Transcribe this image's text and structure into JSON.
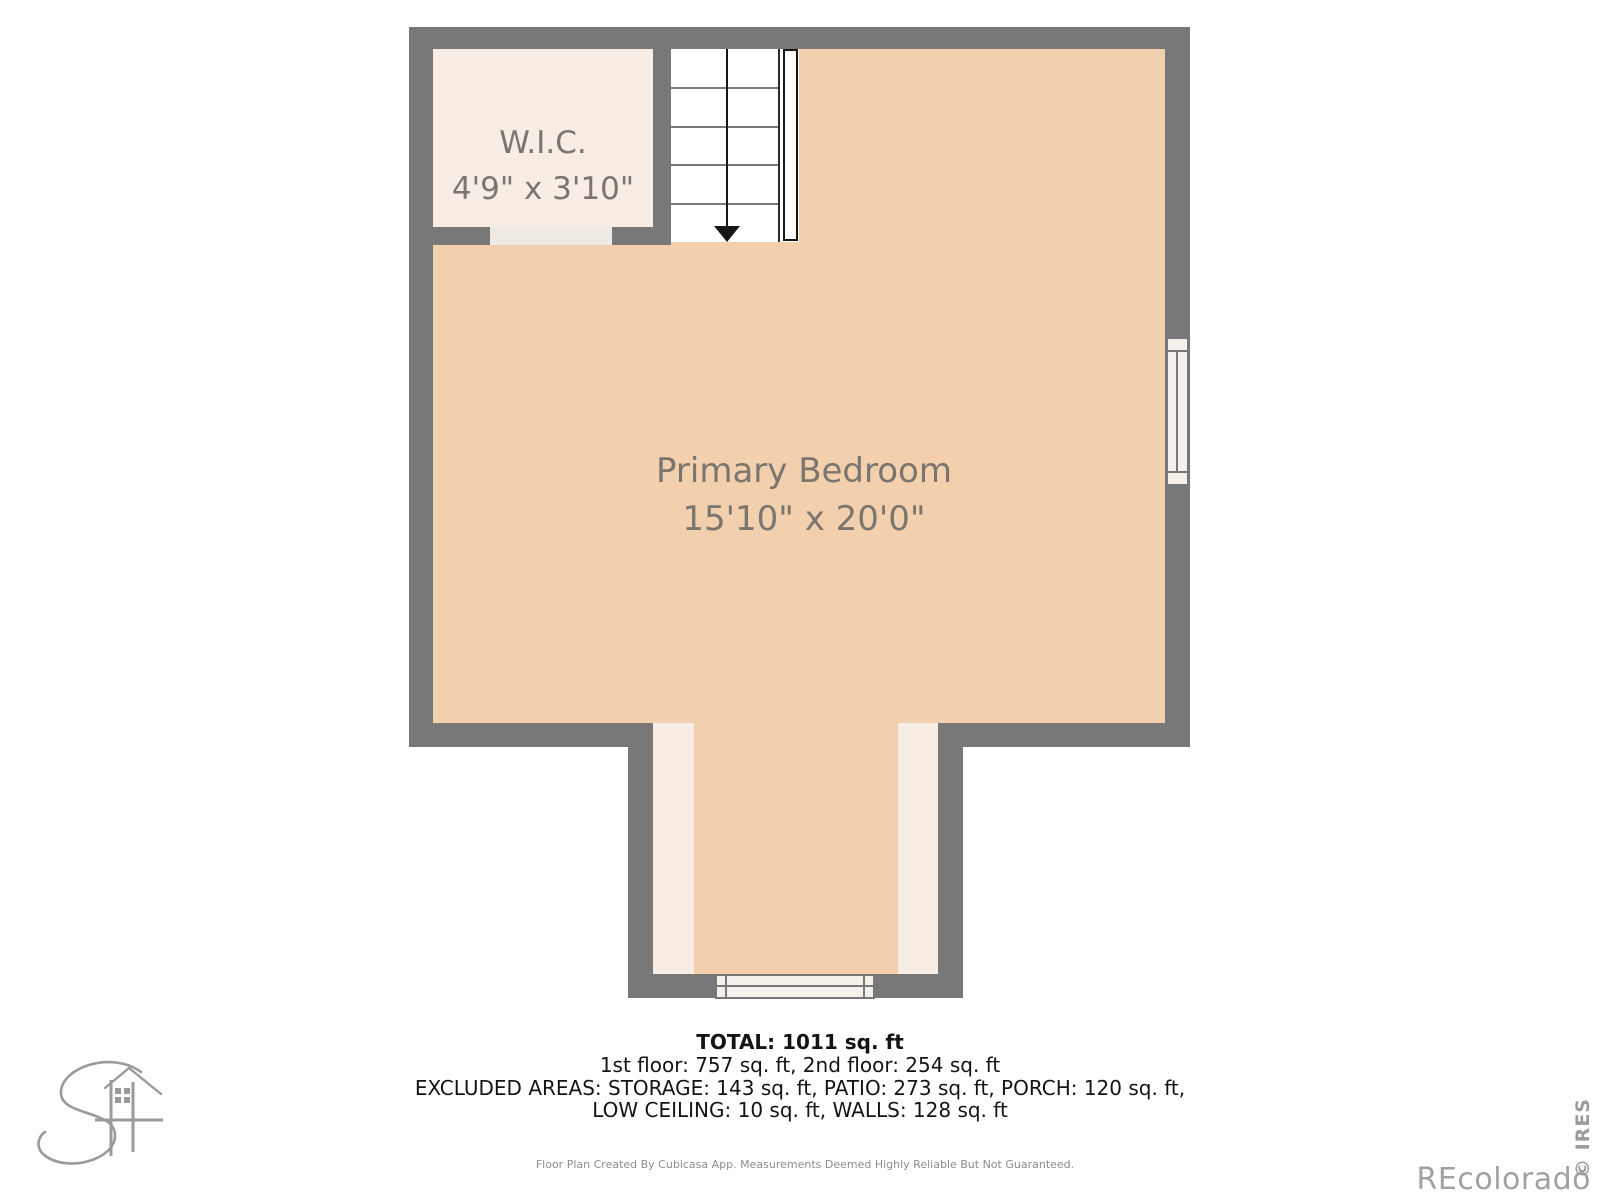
{
  "plan": {
    "rooms": {
      "wic": {
        "name": "W.I.C.",
        "dims": "4'9\" x 3'10\""
      },
      "bedroom": {
        "name": "Primary Bedroom",
        "dims": "15'10\" x 20'0\""
      }
    },
    "stairs": {
      "direction": "down",
      "arrow_icon": "▼"
    }
  },
  "summary": {
    "total": "TOTAL: 1011 sq. ft",
    "floors": "1st floor: 757 sq. ft, 2nd floor: 254 sq. ft",
    "excluded_line1": "EXCLUDED AREAS: STORAGE: 143 sq. ft, PATIO: 273 sq. ft, PORCH: 120 sq. ft,",
    "excluded_line2": "LOW CEILING: 10 sq. ft, WALLS: 128 sq. ft"
  },
  "footer": {
    "disclaimer": "Floor Plan Created By Cubicasa App. Measurements Deemed Highly Reliable But Not Guaranteed."
  },
  "watermarks": {
    "recolorado": "REcolorado",
    "ires": "© IRES"
  },
  "colors": {
    "wall": "#787878",
    "bedroom_floor": "#f2d0ae",
    "closet_floor": "#f8ede5",
    "door_opening": "#efe9e4",
    "stairs": "#ffffff",
    "room_text": "#7b756e",
    "summary_text": "#141414",
    "watermark_text": "#a1a1a1"
  }
}
